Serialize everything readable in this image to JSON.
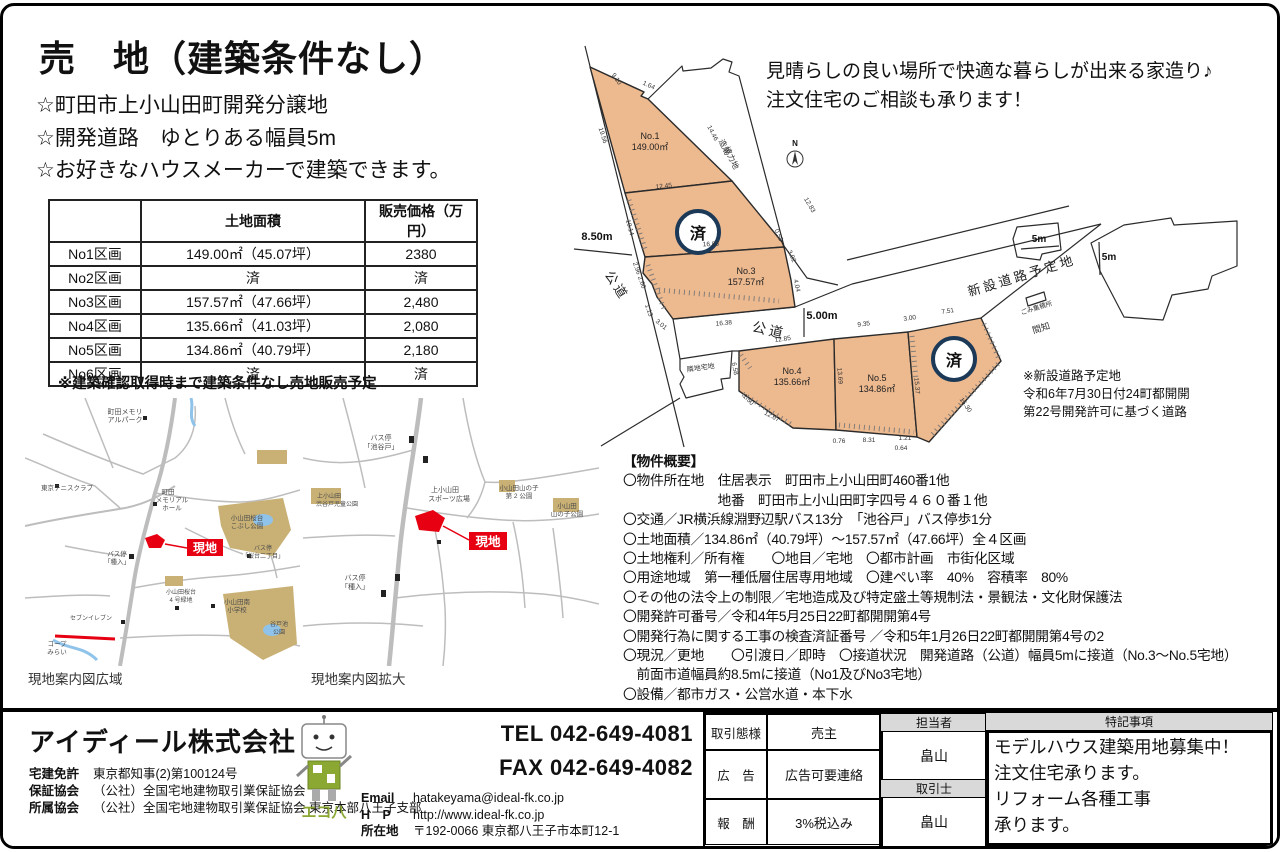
{
  "page": {
    "title": "売　地（建築条件なし）",
    "bullets": [
      "☆町田市上小山田町開発分譲地",
      "☆開発道路　ゆとりある幅員5m",
      "☆お好きなハウスメーカーで建築できます。"
    ],
    "promo_lines": [
      "見晴らしの良い場所で快適な暮らしが出来る家造り♪",
      "注文住宅のご相談も承ります！"
    ]
  },
  "price_table": {
    "headers": [
      "",
      "土地面積",
      "販売価格（万円）"
    ],
    "rows": [
      [
        "No1区画",
        "149.00㎡（45.07坪）",
        "2380"
      ],
      [
        "No2区画",
        "済",
        "済"
      ],
      [
        "No3区画",
        "157.57㎡（47.66坪）",
        "2,480"
      ],
      [
        "No4区画",
        "135.66㎡（41.03坪）",
        "2,080"
      ],
      [
        "No5区画",
        "134.86㎡（40.79坪）",
        "2,180"
      ],
      [
        "No6区画",
        "済",
        "済"
      ]
    ],
    "note": "※建築確認取得時まで建築条件なし売地販売予定"
  },
  "summary": {
    "title": "【物件概要】",
    "lines": [
      "〇物件所在地　住居表示　町田市上小山田町460番1他",
      "　　　　　　　地番　町田市上小山田町字四号４６０番１他",
      "〇交通／JR横浜線淵野辺駅バス13分　「池谷戸」バス停歩1分",
      "〇土地面積／134.86㎡（40.79坪）～157.57㎡（47.66坪）全４区画",
      "〇土地権利／所有権　　〇地目／宅地　〇都市計画　市街化区域",
      "〇用途地域　第一種低層住居専用地域　〇建ぺい率　40%　容積率　80%",
      "〇その他の法令上の制限／宅地造成及び特定盛土等規制法・景観法・文化財保護法",
      "〇開発許可番号／令和4年5月25日22町都開開第4号",
      "〇開発行為に関する工事の検査済証番号 ／令和5年1月26日22町都開開第4号の2",
      "〇現況／更地　　〇引渡日／即時　〇接道状況　開発道路（公道）幅員5mに接道（No.3～No.5宅地）",
      "　前面市道幅員約8.5mに接道（No1及びNo3宅地）",
      "〇設備／都市ガス・公営水道・本下水"
    ]
  },
  "plot_plan": {
    "sold_label": "済",
    "note_lines": [
      "※新設道路予定地",
      "令和6年7月30日付24町都開開",
      "第22号開発許可に基づく道路"
    ],
    "labels": [
      {
        "t": "公道",
        "x": 42,
        "y": 260,
        "r": 57,
        "s": 13,
        "c": "road"
      },
      {
        "t": "公道",
        "x": 197,
        "y": 307,
        "r": 13,
        "s": 14,
        "c": "road"
      },
      {
        "t": "新設道路予定地",
        "x": 452,
        "y": 252,
        "r": -17,
        "s": 13,
        "c": "road"
      },
      {
        "t": "No.1",
        "x": 79,
        "y": 111,
        "s": 9,
        "c": "pn"
      },
      {
        "t": "149.00㎡",
        "x": 79,
        "y": 122,
        "s": 9,
        "c": "pn"
      },
      {
        "t": "No.3",
        "x": 175,
        "y": 246,
        "s": 9,
        "c": "pn"
      },
      {
        "t": "157.57㎡",
        "x": 175,
        "y": 257,
        "s": 9,
        "c": "pn"
      },
      {
        "t": "No.4",
        "x": 221,
        "y": 346,
        "s": 9,
        "c": "pn"
      },
      {
        "t": "135.66㎡",
        "x": 221,
        "y": 357,
        "s": 9,
        "c": "pn"
      },
      {
        "t": "No.5",
        "x": 306,
        "y": 353,
        "s": 9,
        "c": "pn"
      },
      {
        "t": "134.86㎡",
        "x": 306,
        "y": 364,
        "s": 9,
        "c": "pn"
      },
      {
        "t": "造成",
        "x": 151,
        "y": 120,
        "r": 65,
        "s": 8
      },
      {
        "t": "協力地",
        "x": 158,
        "y": 131,
        "r": 65,
        "s": 8
      },
      {
        "t": "隣地宅地",
        "x": 130,
        "y": 342,
        "r": -8,
        "s": 7
      },
      {
        "t": "ごみ集積所",
        "x": 466,
        "y": 282,
        "r": -17,
        "s": 6.5
      },
      {
        "t": "間知",
        "x": 471,
        "y": 303,
        "r": -17,
        "s": 9
      },
      {
        "t": "N",
        "x": 224,
        "y": 118,
        "s": 8,
        "c": "m"
      },
      {
        "t": "8.50m",
        "x": 26,
        "y": 212,
        "s": 11,
        "c": "m"
      },
      {
        "t": "5.00m",
        "x": 251,
        "y": 291,
        "s": 11,
        "c": "m"
      },
      {
        "t": "5m",
        "x": 468,
        "y": 214,
        "s": 10,
        "c": "m"
      },
      {
        "t": "5m",
        "x": 538,
        "y": 232,
        "s": 10,
        "c": "m"
      },
      {
        "t": "9.10",
        "x": 44,
        "y": 52,
        "r": 55,
        "s": 6.5
      },
      {
        "t": "1.64",
        "x": 77,
        "y": 59,
        "r": 25,
        "s": 6.5
      },
      {
        "t": "19.56",
        "x": 30,
        "y": 108,
        "r": 72,
        "s": 6.5
      },
      {
        "t": "14.46",
        "x": 140,
        "y": 106,
        "r": 62,
        "s": 6.5
      },
      {
        "t": "12.45",
        "x": 93,
        "y": 160,
        "r": -6,
        "s": 6.5
      },
      {
        "t": "10.14",
        "x": 57,
        "y": 200,
        "r": 75,
        "s": 6.5
      },
      {
        "t": "12.83",
        "x": 237,
        "y": 178,
        "r": 60,
        "s": 6.5
      },
      {
        "t": "0.59",
        "x": 206,
        "y": 208,
        "r": 65,
        "s": 6.5
      },
      {
        "t": "3.92",
        "x": 219,
        "y": 229,
        "r": 65,
        "s": 6.5
      },
      {
        "t": "4.04",
        "x": 224,
        "y": 258,
        "r": 78,
        "s": 6.5
      },
      {
        "t": "16.83",
        "x": 140,
        "y": 218,
        "r": -3,
        "s": 6.5
      },
      {
        "t": "2.96",
        "x": 64,
        "y": 241,
        "r": 70,
        "s": 6.5
      },
      {
        "t": "2.60",
        "x": 69,
        "y": 255,
        "r": 70,
        "s": 6.5
      },
      {
        "t": "1.13",
        "x": 76,
        "y": 283,
        "r": 70,
        "s": 6.5
      },
      {
        "t": "3.01",
        "x": 89,
        "y": 298,
        "r": 40,
        "s": 6.5
      },
      {
        "t": "16.38",
        "x": 153,
        "y": 297,
        "r": -5,
        "s": 6.5
      },
      {
        "t": "12.85",
        "x": 212,
        "y": 313,
        "r": -8,
        "s": 6.5
      },
      {
        "t": "9.35",
        "x": 293,
        "y": 298,
        "r": -8,
        "s": 6.5
      },
      {
        "t": "3.00",
        "x": 339,
        "y": 292,
        "r": -8,
        "s": 6.5
      },
      {
        "t": "7.51",
        "x": 377,
        "y": 285,
        "r": -8,
        "s": 6.5
      },
      {
        "t": "6.58",
        "x": 162,
        "y": 341,
        "r": 80,
        "s": 6.5
      },
      {
        "t": "1.50",
        "x": 176,
        "y": 373,
        "r": 45,
        "s": 6.5
      },
      {
        "t": "12.67",
        "x": 200,
        "y": 390,
        "r": 28,
        "s": 6.5
      },
      {
        "t": "0.76",
        "x": 268,
        "y": 415,
        "s": 6.5
      },
      {
        "t": "8.31",
        "x": 298,
        "y": 414,
        "s": 6.5
      },
      {
        "t": "1.21",
        "x": 334,
        "y": 412,
        "s": 6.5
      },
      {
        "t": "0.64",
        "x": 330,
        "y": 422,
        "s": 6.5
      },
      {
        "t": "13.69",
        "x": 267,
        "y": 348,
        "r": 85,
        "s": 6.5
      },
      {
        "t": "15.37",
        "x": 344,
        "y": 358,
        "r": 85,
        "s": 6.5
      },
      {
        "t": "15.30",
        "x": 393,
        "y": 378,
        "r": 55,
        "s": 6.5
      }
    ]
  },
  "maps": {
    "site_label": "現地",
    "wide": {
      "caption": "現地案内図広域",
      "labels": [
        {
          "t": "町田メモリ",
          "x": 100,
          "y": 16,
          "s": 7
        },
        {
          "t": "アルパーク",
          "x": 100,
          "y": 24,
          "s": 7
        },
        {
          "t": "東京テニスクラブ",
          "x": 42,
          "y": 92,
          "s": 6.5
        },
        {
          "t": "町田",
          "x": 143,
          "y": 96,
          "s": 6.5
        },
        {
          "t": "メモリアル",
          "x": 147,
          "y": 104,
          "s": 6.5
        },
        {
          "t": "ホール",
          "x": 147,
          "y": 112,
          "s": 6.5
        },
        {
          "t": "小山田桜台",
          "x": 222,
          "y": 122,
          "s": 6.5
        },
        {
          "t": "こぶし公園",
          "x": 222,
          "y": 130,
          "s": 6.5
        },
        {
          "t": "バス停",
          "x": 92,
          "y": 158,
          "s": 6.5
        },
        {
          "t": "「種入」",
          "x": 92,
          "y": 166,
          "s": 6.5
        },
        {
          "t": "バス停",
          "x": 238,
          "y": 152,
          "s": 6
        },
        {
          "t": "「桜台二丁目」",
          "x": 238,
          "y": 160,
          "s": 6
        },
        {
          "t": "小山田桜台",
          "x": 156,
          "y": 196,
          "s": 6
        },
        {
          "t": "4 号緑地",
          "x": 156,
          "y": 204,
          "s": 6
        },
        {
          "t": "小山田南",
          "x": 212,
          "y": 206,
          "s": 6.5
        },
        {
          "t": "小学校",
          "x": 212,
          "y": 214,
          "s": 6.5
        },
        {
          "t": "谷戸池",
          "x": 254,
          "y": 228,
          "s": 6
        },
        {
          "t": "公園",
          "x": 254,
          "y": 236,
          "s": 6
        },
        {
          "t": "セブンイレブン",
          "x": 66,
          "y": 222,
          "s": 6
        },
        {
          "t": "コープ",
          "x": 32,
          "y": 248,
          "s": 6.5
        },
        {
          "t": "みらい",
          "x": 32,
          "y": 256,
          "s": 6.5
        }
      ]
    },
    "zoomed": {
      "caption": "現地案内図拡大",
      "labels": [
        {
          "t": "バス停",
          "x": 78,
          "y": 42,
          "s": 7
        },
        {
          "t": "「池谷戸」",
          "x": 78,
          "y": 51,
          "s": 7
        },
        {
          "t": "上小山田",
          "x": 142,
          "y": 94,
          "s": 7
        },
        {
          "t": "スポーツ広場",
          "x": 146,
          "y": 103,
          "s": 7
        },
        {
          "t": "小山田山の子",
          "x": 216,
          "y": 92,
          "s": 6.5
        },
        {
          "t": "第 2 公園",
          "x": 216,
          "y": 100,
          "s": 6.5
        },
        {
          "t": "小山田",
          "x": 264,
          "y": 110,
          "s": 6.5
        },
        {
          "t": "山の子公園",
          "x": 264,
          "y": 118,
          "s": 6.5
        },
        {
          "t": "上小山田",
          "x": 26,
          "y": 100,
          "s": 6
        },
        {
          "t": "渋谷戸児童公園",
          "x": 34,
          "y": 108,
          "s": 6
        },
        {
          "t": "バス停",
          "x": 52,
          "y": 182,
          "s": 7
        },
        {
          "t": "「種入」",
          "x": 52,
          "y": 191,
          "s": 7
        }
      ]
    }
  },
  "footer": {
    "company": "アイディール株式会社",
    "licenses": [
      {
        "label": "宅建免許",
        "value": "東京都知事(2)第100124号"
      },
      {
        "label": "保証協会",
        "value": "（公社）全国宅地建物取引業保証協会"
      },
      {
        "label": "所属協会",
        "value": "（公社）全国宅地建物取引業保証協会 東京本部八王子支部"
      }
    ],
    "mascot_name": "エコ八",
    "tel": "TEL 042-649-4081",
    "fax": "FAX 042-649-4082",
    "contacts": [
      {
        "label": "Email",
        "value": "hatakeyama@ideal-fk.co.jp"
      },
      {
        "label": "H　P",
        "value": "http://www.ideal-fk.co.jp"
      },
      {
        "label": "所在地",
        "value": "〒192-0066 東京都八王子市本町12-1"
      }
    ],
    "deal_rows": [
      {
        "label": "取引態様",
        "value": "売主"
      },
      {
        "label": "広　告",
        "value": "広告可要連絡"
      },
      {
        "label": "報　酬",
        "value": "3%税込み"
      }
    ],
    "staff": {
      "manager_label": "担当者",
      "manager": "畠山",
      "agent_label": "取引士",
      "agent": "畠山"
    },
    "notes": {
      "title": "特記事項",
      "lines": [
        "モデルハウス建築用地募集中！",
        "注文住宅承ります。",
        "リフォーム各種工事",
        "承ります。"
      ]
    }
  },
  "colors": {
    "plot_fill": "#edb98f",
    "sold_ring": "#1c3a57",
    "site_red": "#e60012",
    "park": "#c9b176",
    "pond": "#8fc3ea",
    "road_gray": "#bdbdbd"
  }
}
